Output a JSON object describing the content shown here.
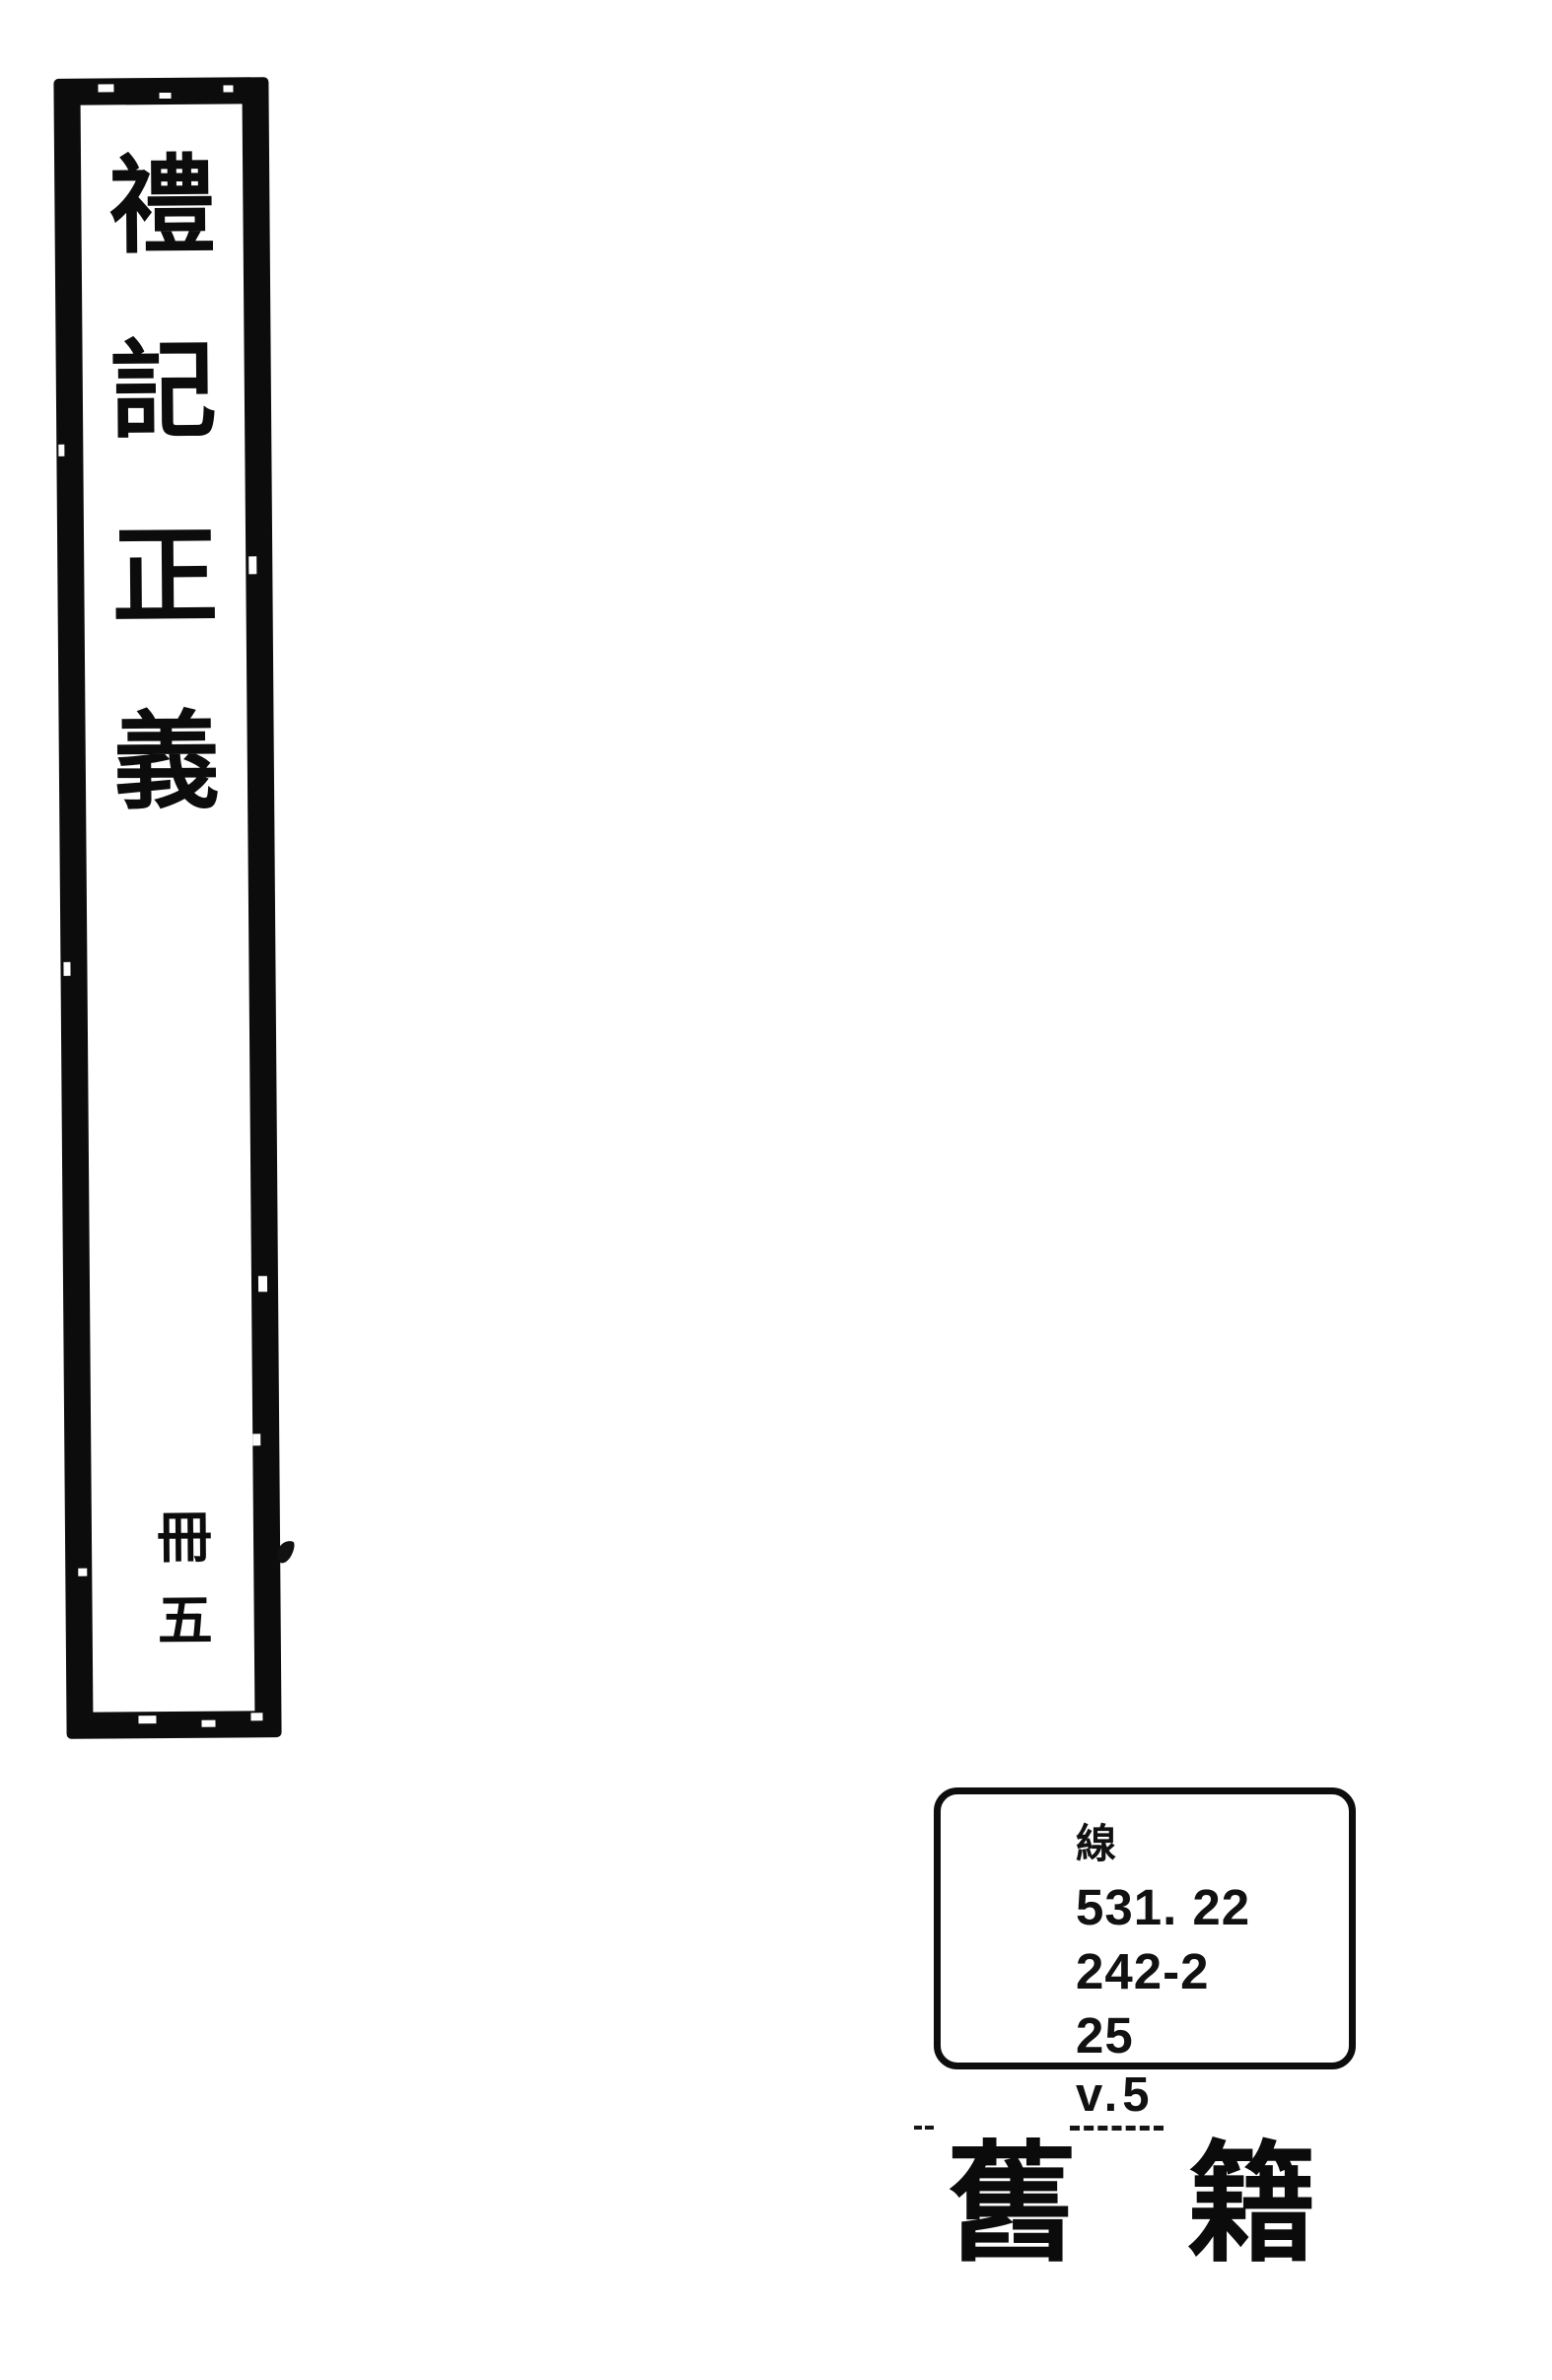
{
  "colors": {
    "ink": "#0b0b0b",
    "paper": "#ffffff"
  },
  "spine_label": {
    "title": "禮記正義",
    "title_chars": [
      "禮",
      "記",
      "正",
      "義"
    ],
    "volume": "冊五",
    "volume_chars": [
      "冊",
      "五"
    ]
  },
  "call_number_label": {
    "lines": [
      "線",
      "531. 22",
      "242-2",
      "25"
    ],
    "volume_note": "v.5"
  },
  "bottom_stamp": {
    "text": "舊籍",
    "chars": [
      "舊",
      "籍"
    ]
  }
}
